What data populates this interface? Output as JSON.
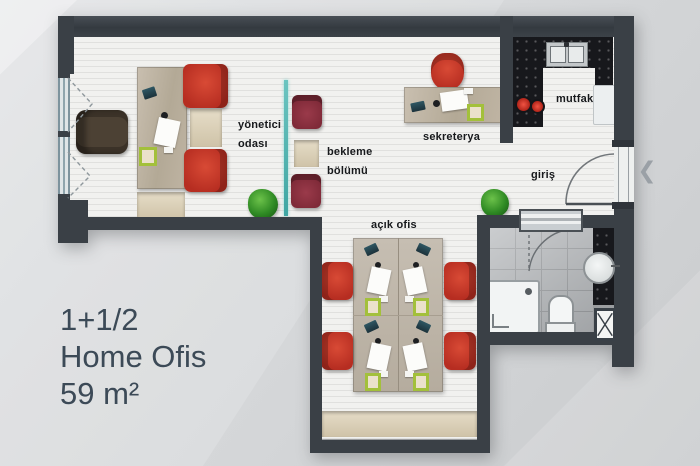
{
  "title_block": {
    "type": "1+1/2",
    "name": "Home Ofis",
    "area": "59 m²"
  },
  "rooms": {
    "manager_office": {
      "line1": "yönetici",
      "line2": "odası"
    },
    "waiting_area": {
      "line1": "bekleme",
      "line2": "bölümü"
    },
    "secretary": {
      "label": "sekreterya"
    },
    "kitchen": {
      "label": "mutfak"
    },
    "entrance": {
      "label": "giriş"
    },
    "open_office": {
      "label": "açık ofis"
    }
  },
  "icons": {
    "prev_arrow": "❮"
  },
  "colors": {
    "wall": "#3a4046",
    "floor": "#f1f1ef",
    "accent_red": "#c43a2b",
    "waiting_maroon": "#8e3242",
    "glass_teal": "#55b8b5",
    "counter_black": "#17181c",
    "wood": "#bfb5a5",
    "label_text": "#17191c",
    "title_text": "#3c4a57",
    "background": "#d6d8da"
  }
}
